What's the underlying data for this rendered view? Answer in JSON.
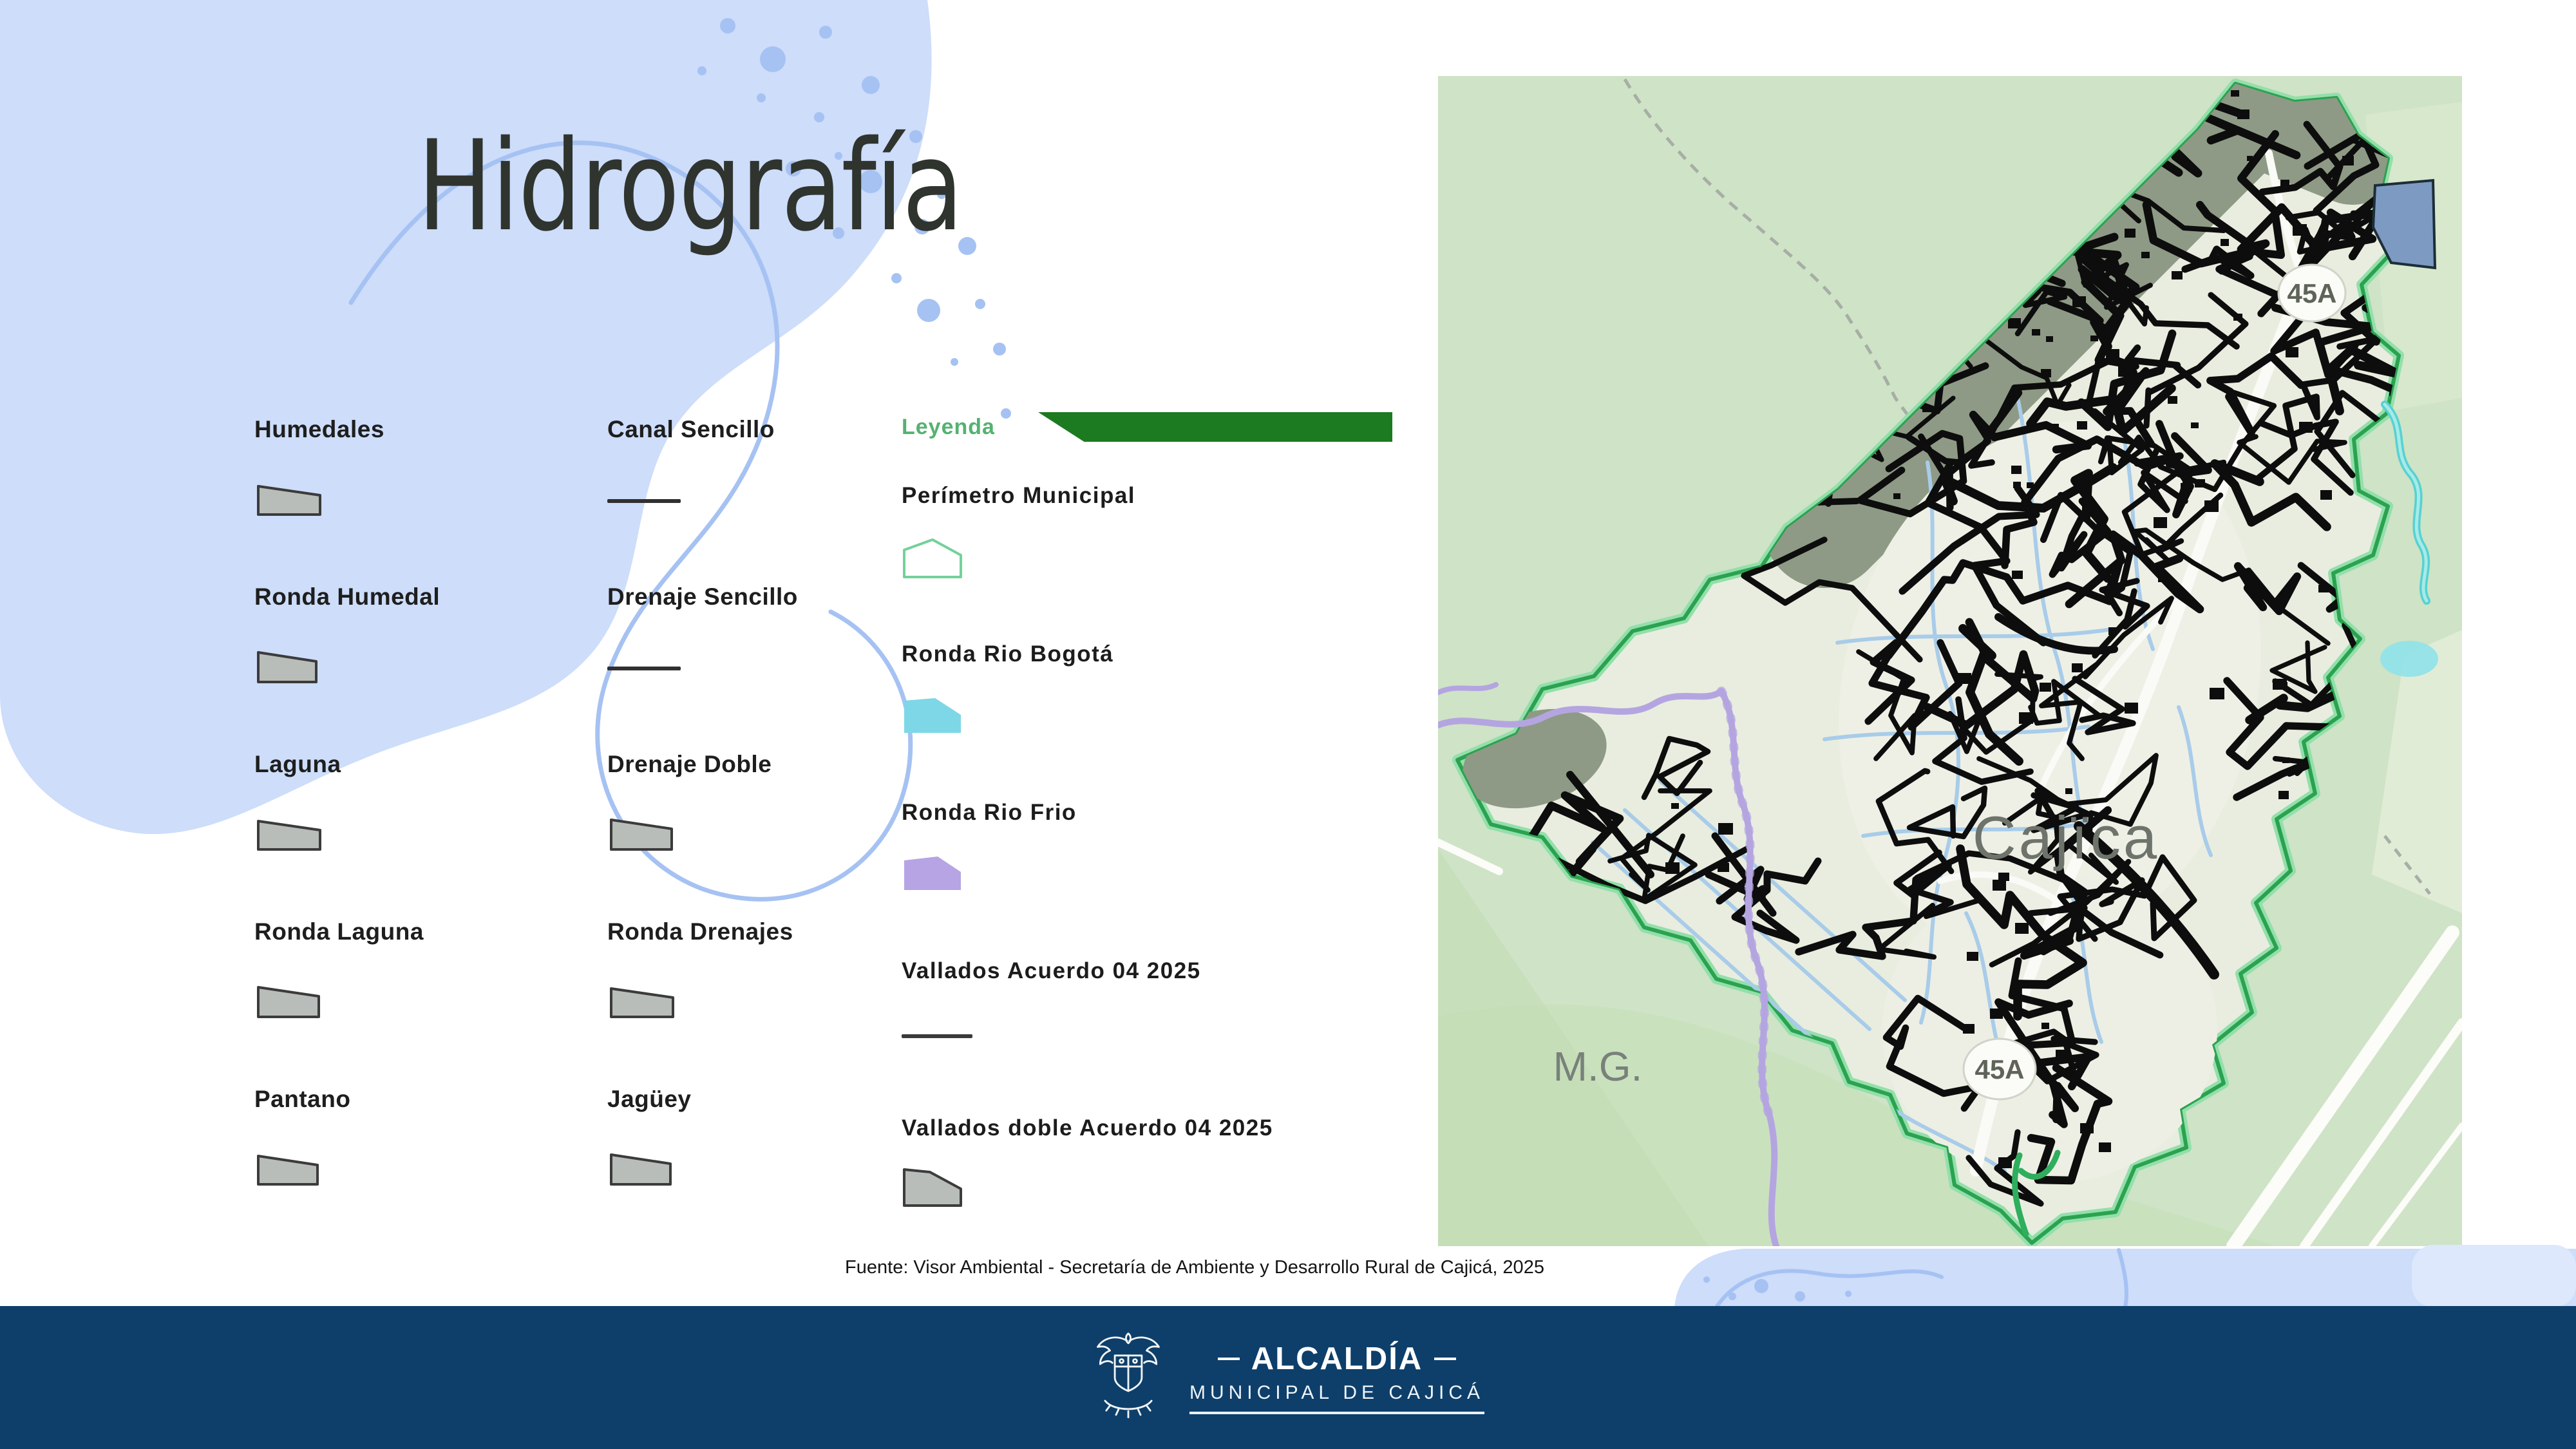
{
  "slide": {
    "title": "Hidrografía",
    "source_note": "Fuente: Visor Ambiental - Secretaría de Ambiente y Desarrollo Rural de Cajicá, 2025"
  },
  "legend": {
    "column1": [
      {
        "label": "Humedales",
        "symbol": "polygon-gray"
      },
      {
        "label": "Ronda Humedal",
        "symbol": "polygon-gray"
      },
      {
        "label": "Laguna",
        "symbol": "polygon-gray"
      },
      {
        "label": "Ronda Laguna",
        "symbol": "polygon-gray"
      },
      {
        "label": "Pantano",
        "symbol": "polygon-gray"
      }
    ],
    "column2": [
      {
        "label": "Canal Sencillo",
        "symbol": "line-dark"
      },
      {
        "label": "Drenaje Sencillo",
        "symbol": "line-dark"
      },
      {
        "label": "Drenaje Doble",
        "symbol": "polygon-gray"
      },
      {
        "label": "Ronda Drenajes",
        "symbol": "polygon-gray"
      },
      {
        "label": "Jagüey",
        "symbol": "polygon-gray"
      }
    ]
  },
  "leyenda_panel": {
    "header": "Leyenda",
    "items": [
      {
        "label": "Perímetro Municipal",
        "symbol": "polygon-outline-green"
      },
      {
        "label": "Ronda Rio Bogotá",
        "symbol": "polygon-cyan"
      },
      {
        "label": "Ronda Rio Frio",
        "symbol": "polygon-purple"
      },
      {
        "label": "Vallados Acuerdo 04 2025",
        "symbol": "line-dark"
      },
      {
        "label": "Vallados doble Acuerdo 04 2025",
        "symbol": "polygon-gray"
      }
    ]
  },
  "map": {
    "labels": {
      "city": "Cajïca",
      "neighbor": "M.G.",
      "route_shield": "45A"
    }
  },
  "footer": {
    "org_line1": "ALCALDÍA",
    "org_line2": "MUNICIPAL DE CAJICÁ"
  },
  "colors": {
    "accent_blue_blob": "#cdddfa",
    "accent_blue_line": "#a6c2f3",
    "navy_bar": "#0e3f6a",
    "leyenda_green_text": "#55b271",
    "leyenda_banner_green": "#1c7a20",
    "map_background_green": "#cfe3c6",
    "map_boundary_green": "#2ba24f",
    "ronda_bogota_cyan": "#7ed7e6",
    "ronda_frio_purple": "#b6a4e4",
    "symbol_gray": "#b9bdb9",
    "title_color": "#2f342e"
  }
}
